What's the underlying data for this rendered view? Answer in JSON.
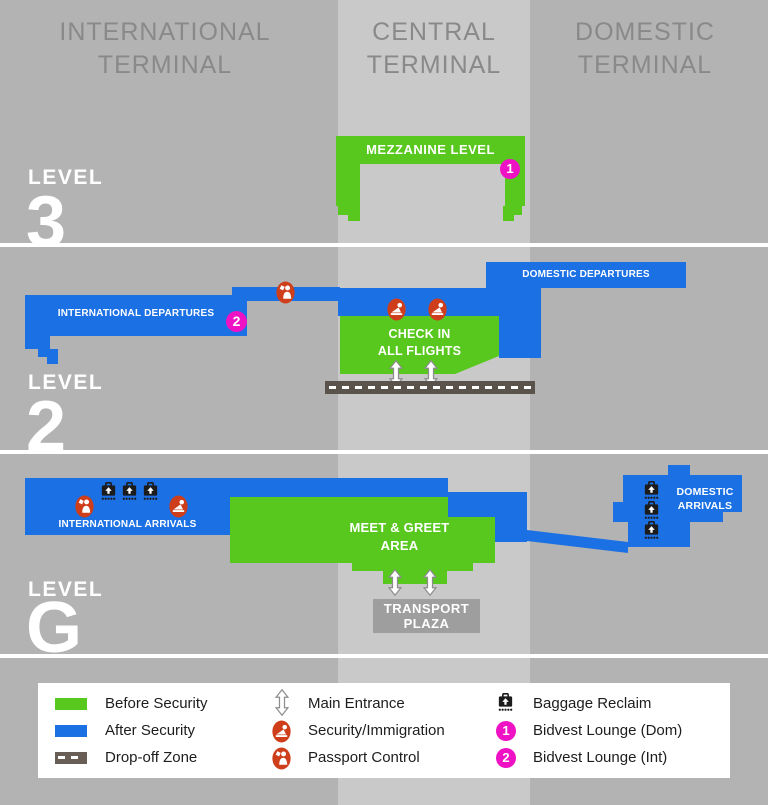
{
  "terminal_headers": {
    "international": "INTERNATIONAL\nTERMINAL",
    "central": "CENTRAL\nTERMINAL",
    "domestic": "DOMESTIC\nTERMINAL"
  },
  "level3": {
    "label": "LEVEL",
    "number": "3",
    "mezzanine": "MEZZANINE LEVEL",
    "badge": "1"
  },
  "level2": {
    "label": "LEVEL",
    "number": "2",
    "international_departures": "INTERNATIONAL DEPARTURES",
    "domestic_departures": "DOMESTIC DEPARTURES",
    "check_in": "CHECK IN\nALL FLIGHTS",
    "badge": "2"
  },
  "level_g": {
    "label": "LEVEL",
    "number": "G",
    "international_arrivals": "INTERNATIONAL ARRIVALS",
    "meet_greet": "MEET & GREET\nAREA",
    "domestic_arrivals": "DOMESTIC\nARRIVALS",
    "transport_plaza": "TRANSPORT\nPLAZA"
  },
  "legend": {
    "items": [
      {
        "icon": "before-security-swatch",
        "label": "Before Security"
      },
      {
        "icon": "after-security-swatch",
        "label": "After Security"
      },
      {
        "icon": "drop-off-swatch",
        "label": "Drop-off Zone"
      },
      {
        "icon": "main-entrance-arrow",
        "label": "Main Entrance"
      },
      {
        "icon": "security-immigration-icon",
        "label": "Security/Immigration"
      },
      {
        "icon": "passport-control-icon",
        "label": "Passport Control"
      },
      {
        "icon": "baggage-reclaim-icon",
        "label": "Baggage Reclaim"
      },
      {
        "icon": "bidvest-lounge-dom-badge",
        "label": "Bidvest Lounge (Dom)",
        "badge": "1"
      },
      {
        "icon": "bidvest-lounge-int-badge",
        "label": "Bidvest Lounge (Int)",
        "badge": "2"
      }
    ]
  },
  "colors": {
    "before_security": "#58c81e",
    "after_security": "#1b70e4",
    "drop_off_zone": "#5a534c",
    "lounge_badge": "#ee12c4",
    "control_icon": "#cf3e1b",
    "background": "#b3b3b3",
    "central_stripe": "#c9c9c9"
  }
}
